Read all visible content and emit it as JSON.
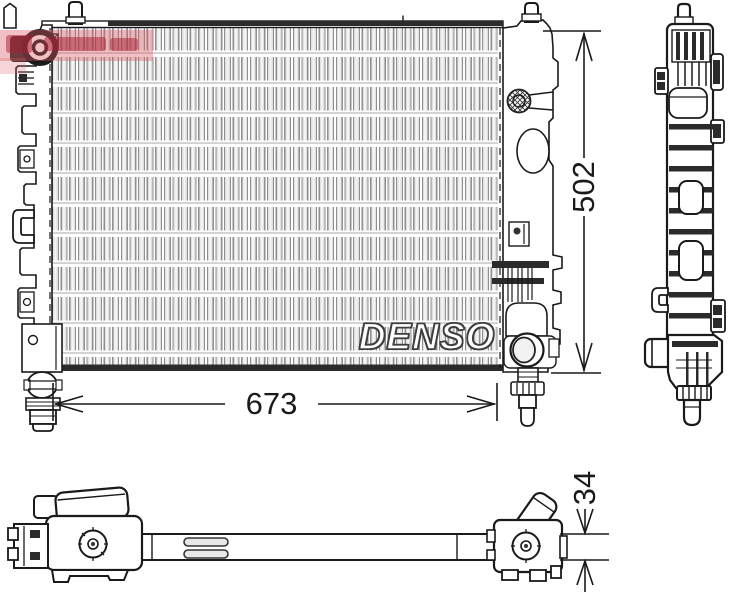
{
  "brand_watermark": {
    "text": "DENSO"
  },
  "dimensions": {
    "width_mm": "673",
    "height_mm": "502",
    "core_depth_mm": "34"
  },
  "colors": {
    "line": "#1a1a1a",
    "ink": "#2b2b2b",
    "fin-dark": "#8f8f8f",
    "fin-light": "#e0e0e0",
    "denso-outline": "#3f3f3f",
    "watermark-red-bg": "rgba(221,90,100,0.38)"
  },
  "icons": {
    "inlet_port": "thick-ring",
    "filler_cap": "crosshatched-circle",
    "outlet_port": "double-circle",
    "drain_plug": "ribbed-cylinder"
  }
}
